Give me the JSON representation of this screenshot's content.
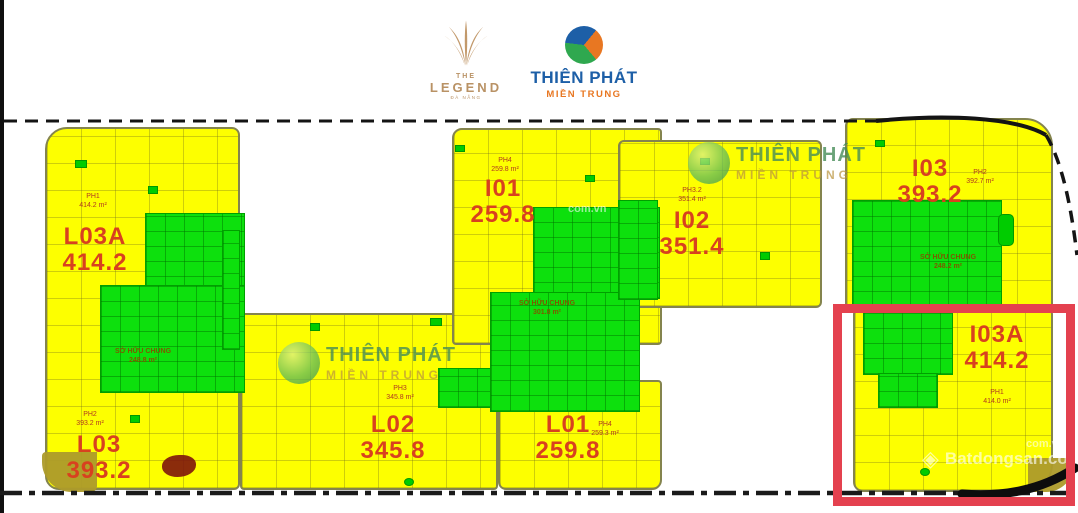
{
  "header": {
    "legend": {
      "the": "THE",
      "name": "LEGEND",
      "sub": "ĐÀ NẴNG"
    },
    "thienphat": {
      "name": "THIÊN PHÁT",
      "sub": "MIỀN TRUNG"
    }
  },
  "watermark": {
    "thienphat_name": "THIÊN PHÁT",
    "thienphat_sub": "MIỀN TRUNG",
    "batdongsan": "Batdongsan.com",
    "batdongsan_sub": "com.vn"
  },
  "units": [
    {
      "code": "L03A",
      "area": "414.2",
      "ph_label": "PH1",
      "ph_area": "414.2 m²"
    },
    {
      "code": "L03",
      "area": "393.2",
      "ph_label": "PH2",
      "ph_area": "393.2 m²"
    },
    {
      "code": "L02",
      "area": "345.8",
      "ph_label": "PH3",
      "ph_area": "345.8 m²"
    },
    {
      "code": "L01",
      "area": "259.8",
      "ph_label": "PH4",
      "ph_area": "259.3 m²"
    },
    {
      "code": "I01",
      "area": "259.8",
      "ph_label": "PH4",
      "ph_area": "259.8 m²"
    },
    {
      "code": "I02",
      "area": "351.4",
      "ph_label": "PH3.2",
      "ph_area": "351.4 m²"
    },
    {
      "code": "I03",
      "area": "393.2",
      "ph_label": "PH2",
      "ph_area": "392.7 m²"
    },
    {
      "code": "I03A",
      "area": "414.2",
      "ph_label": "PH1",
      "ph_area": "414.0 m²"
    }
  ],
  "common_areas": [
    {
      "label": "SỞ HỮU CHUNG",
      "area": "248.8 m²"
    },
    {
      "label": "SỞ HỮU CHUNG",
      "area": "301.8 m²"
    },
    {
      "label": "SỞ HỮU CHUNG",
      "area": "248.2 m²"
    }
  ],
  "colors": {
    "floor_yellow": "#fdff00",
    "common_green": "#0de00d",
    "unit_label_red": "#d8411f",
    "highlight_red": "#e4414f",
    "legend_gold": "#b99265",
    "brand_blue": "#1d5fa7",
    "brand_orange": "#e87722"
  }
}
